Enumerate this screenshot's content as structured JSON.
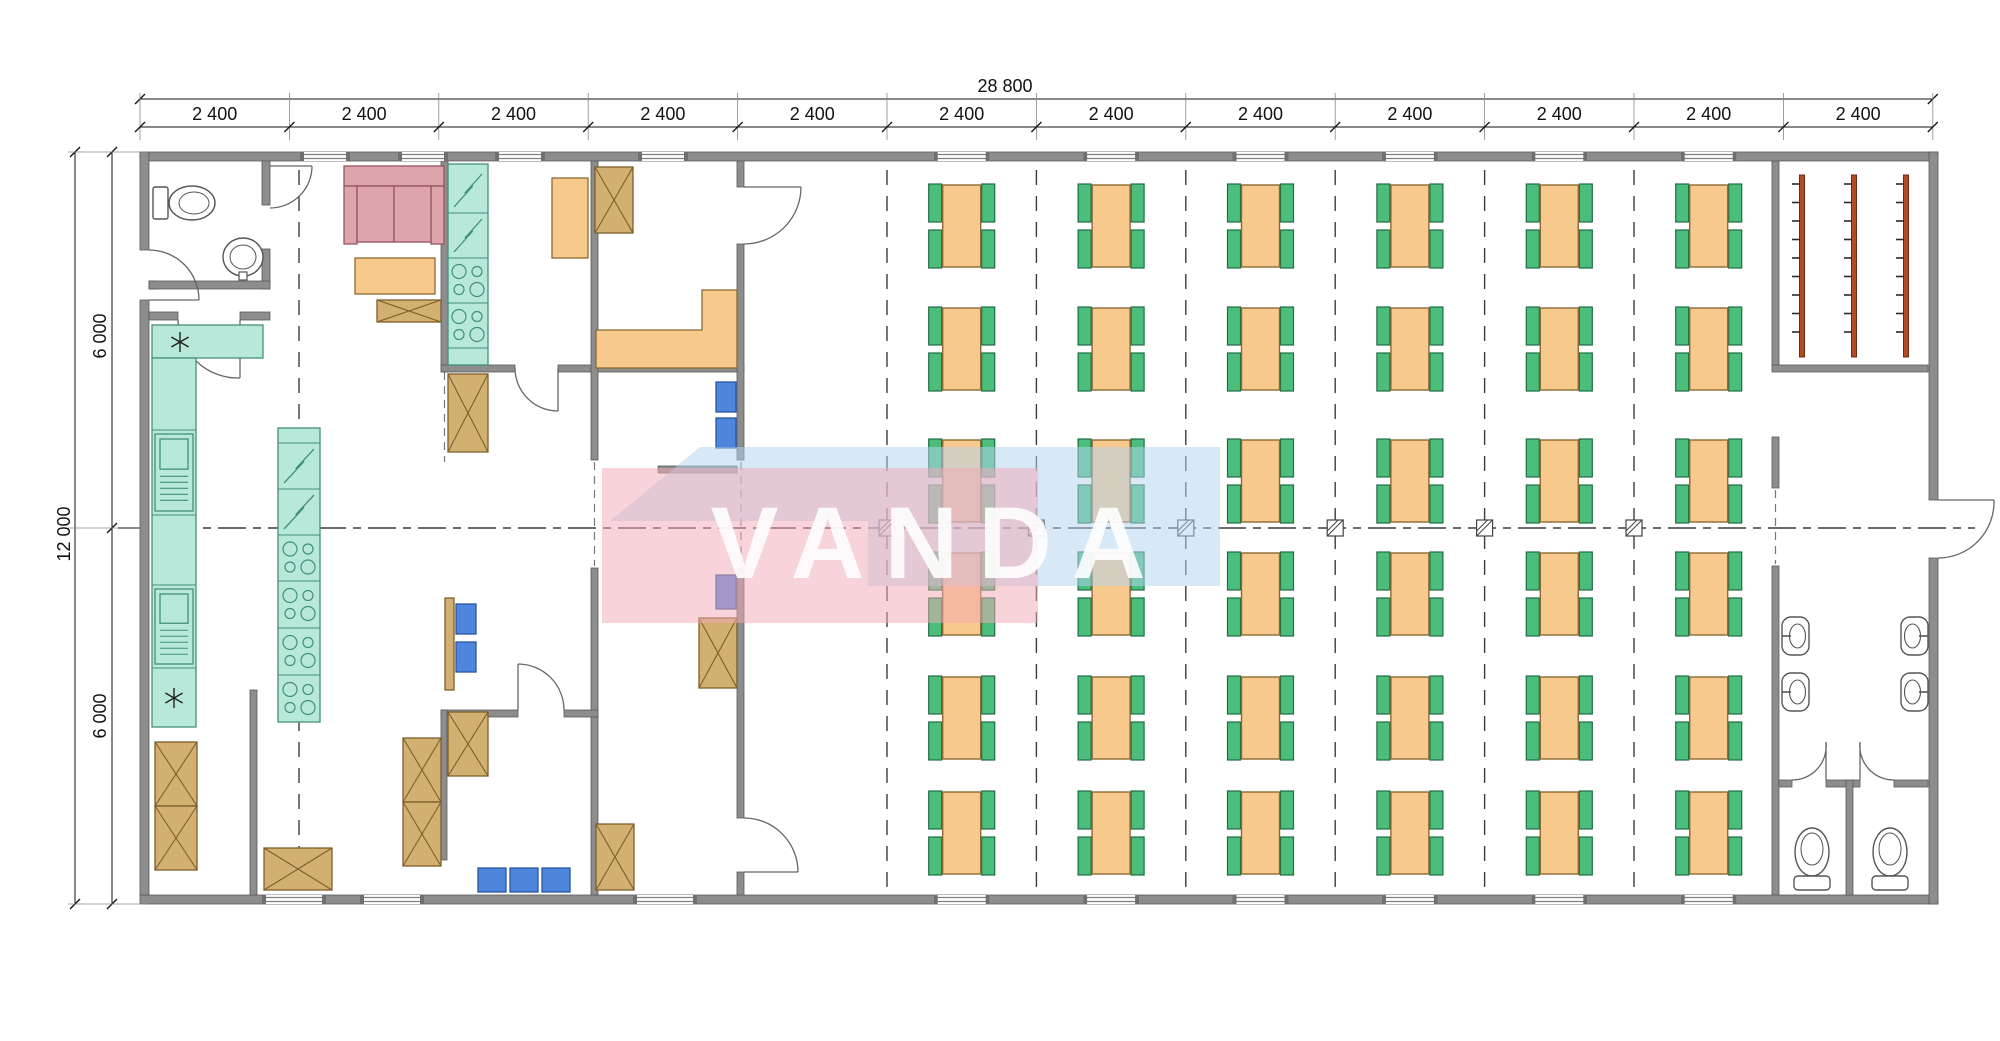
{
  "dimensions": {
    "total_width": "28 800",
    "bays": [
      "2 400",
      "2 400",
      "2 400",
      "2 400",
      "2 400",
      "2 400",
      "2 400",
      "2 400",
      "2 400",
      "2 400",
      "2 400",
      "2 400"
    ],
    "total_height": "12 000",
    "height_halves": [
      "6 000",
      "6 000"
    ]
  },
  "watermark": {
    "text": "VANDA",
    "pink": "#f2aab6",
    "blue": "#b3d2f0"
  },
  "colors": {
    "wall": "#8d8d8d",
    "wall_edge": "#5a5a5a",
    "table": "#f8c98d",
    "table_stroke": "#8a6a33",
    "chair": "#4cbe7c",
    "chair_stroke": "#1f6b43",
    "counter": "#b7e8da",
    "counter_stroke": "#43907c",
    "crate": "#d2b071",
    "crate_stroke": "#7d5f2b",
    "sofa": "#dda4ab",
    "sofa_stroke": "#96555f",
    "box_blue": "#4f86dd",
    "box_blue_stroke": "#2c55a0",
    "rack": "#b34a22",
    "rack_stroke": "#6e2a10",
    "grid_line": "#3c3c3c",
    "fixture_stroke": "#555555"
  },
  "dining_area": {
    "columns": 6,
    "rows": 6,
    "tables": 36,
    "chairs_per_table": 4
  },
  "cloakroom": {
    "racks": 3
  },
  "washroom": {
    "basins": 4,
    "wc_stalls": 2,
    "stall_toilets": 2
  },
  "wc_room": {
    "toilets": 1,
    "basins": 1
  },
  "kitchen": {
    "fridge_cells": 4,
    "cooktop_cells": 6,
    "dishwashers": 2,
    "sink_marks": 2
  }
}
